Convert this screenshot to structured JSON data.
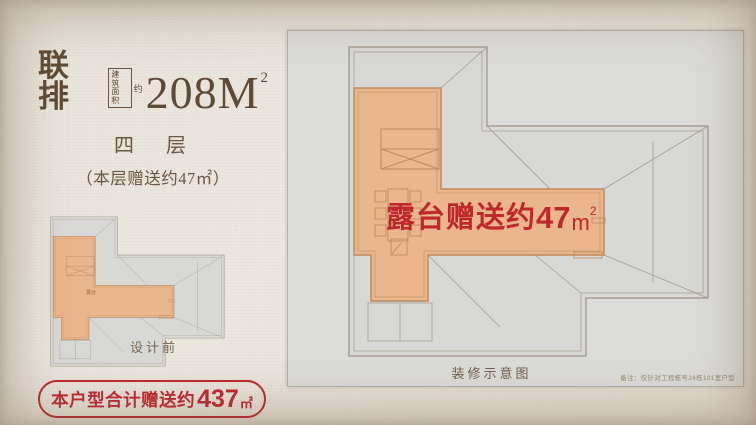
{
  "colors": {
    "accent_red": "#c1262d",
    "title_brown": "#5f4b35",
    "terrace_orange": "#e9b68d",
    "panel_gray": "#dcdcda"
  },
  "header": {
    "type_label": "联排",
    "area_box_line1": "建筑",
    "area_box_line2": "面积",
    "area_approx": "约",
    "area_value": "208M",
    "area_sup": "2"
  },
  "floor_info": {
    "floor_label": "四　层",
    "floor_bonus": "（本层赠送约47㎡）"
  },
  "small_plan": {
    "terrace_tag": "露台",
    "caption": "设计前"
  },
  "summary_badge": {
    "prefix": "本户型合计赠送约",
    "value": "437",
    "unit": "㎡"
  },
  "big_plan": {
    "bonus_label": "露台赠送约",
    "bonus_value": "47",
    "bonus_unit": "m",
    "bonus_sup": "2",
    "caption": "装修示意图",
    "note": "备注：仅针对工程栋号24栋101室户型"
  }
}
